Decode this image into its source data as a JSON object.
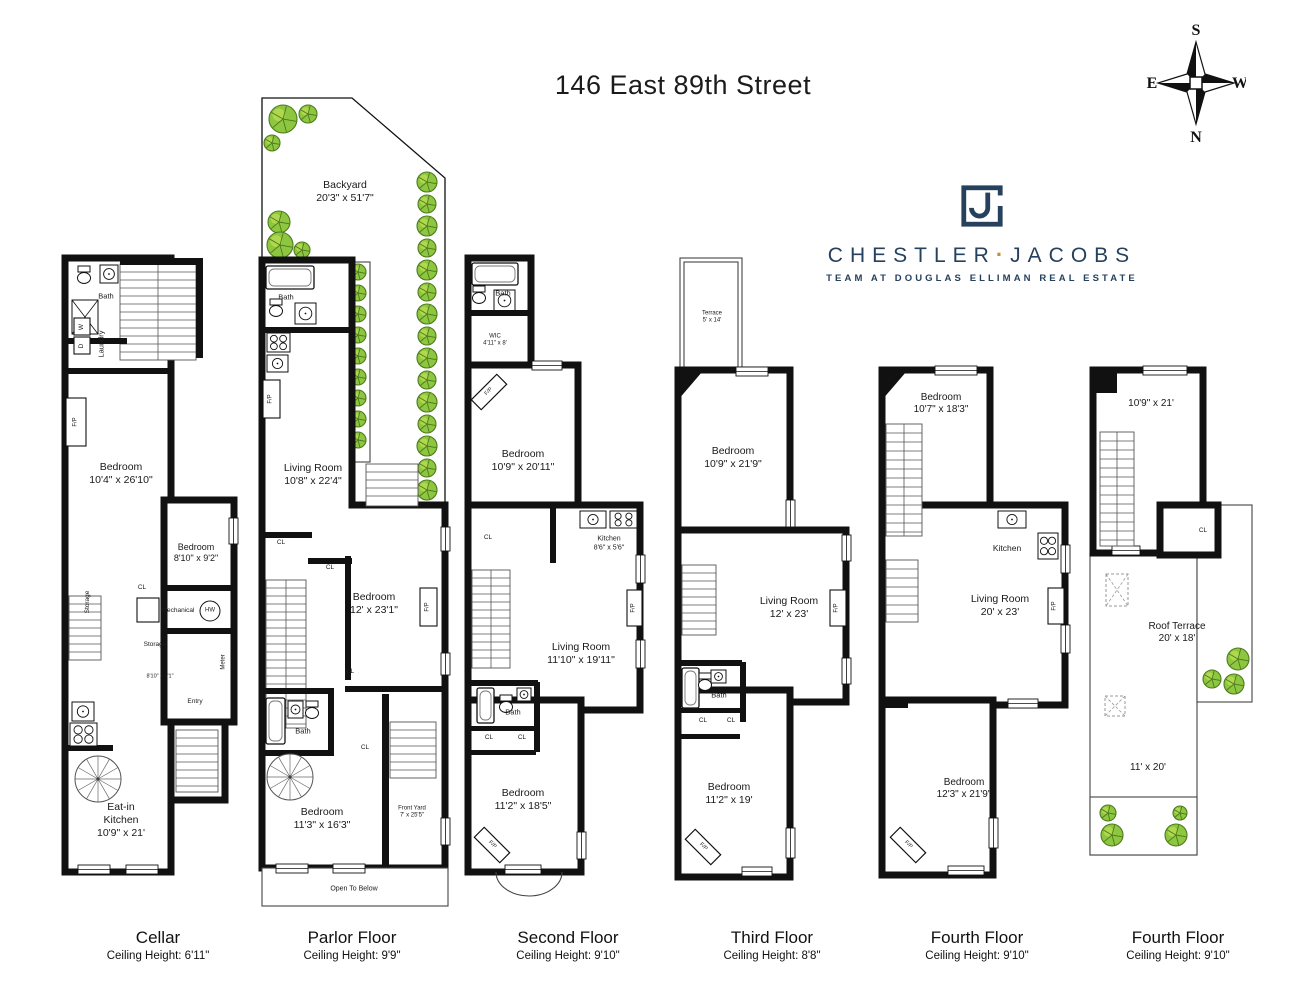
{
  "title": "146 East 89th Street",
  "compass": {
    "top": "S",
    "bottom": "N",
    "left": "E",
    "right": "W"
  },
  "logo": {
    "brand": "CHESTLER",
    "separator": "·",
    "brand2": "JACOBS",
    "tagline": "TEAM AT DOUGLAS ELLIMAN REAL ESTATE",
    "monogram": "CJ"
  },
  "colors": {
    "navy": "#26415e",
    "gold": "#c18f3c",
    "wall": "#111111",
    "tree_green": "#8dc63f",
    "tree_light": "#b9dc52",
    "tree_dark": "#4e7a1e"
  },
  "floors": [
    {
      "name": "Cellar",
      "ceiling": "Ceiling Height: 6'11\"",
      "labels": {
        "bath": "Bath",
        "w": "W",
        "d": "D",
        "laundry": "Laundry",
        "fp": "F/P",
        "bedroom1": [
          "Bedroom",
          "10'4\" x 26'10\""
        ],
        "storage1": "Storage",
        "cl": "CL",
        "bedroom2": [
          "Bedroom",
          "8'10\" x 9'2\""
        ],
        "mechanical": "Mechanical",
        "hw": "HW",
        "storage2": "Storage",
        "meter": "Meter",
        "hall": "8'10\" x 3'1\"",
        "entry": "Entry",
        "kitchen": [
          "Eat-in",
          "Kitchen",
          "10'9\" x 21'"
        ]
      }
    },
    {
      "name": "Parlor Floor",
      "ceiling": "Ceiling Height: 9'9\"",
      "labels": {
        "backyard": [
          "Backyard",
          "20'3\" x 51'7\""
        ],
        "bath1": "Bath",
        "fp1": "F/P",
        "living": [
          "Living Room",
          "10'8\" x 22'4\""
        ],
        "cl1": "CL",
        "cl2": "CL",
        "bedroom1": [
          "Bedroom",
          "12' x 23'1\""
        ],
        "fp2": "F/P",
        "cl3": "CL",
        "bath2": "Bath",
        "cl4": "CL",
        "bedroom2": [
          "Bedroom",
          "11'3\" x 16'3\""
        ],
        "frontyard": [
          "Front Yard",
          "7' x 25'5\""
        ],
        "open": "Open To Below"
      }
    },
    {
      "name": "Second Floor",
      "ceiling": "Ceiling Height: 9'10\"",
      "labels": {
        "bath1": "Bath",
        "wic": [
          "WIC",
          "4'11\" x 8'"
        ],
        "fp1": "F/P",
        "bedroom1": [
          "Bedroom",
          "10'9\" x 20'11\""
        ],
        "cl1": "CL",
        "kitchen": [
          "Kitchen",
          "8'6\" x 5'6\""
        ],
        "fp2": "F/P",
        "living": [
          "Living Room",
          "11'10\" x 19'11\""
        ],
        "bath2": "Bath",
        "cl2": "CL",
        "cl3": "CL",
        "bedroom2": [
          "Bedroom",
          "11'2\" x 18'5\""
        ],
        "fp3": "F/P"
      }
    },
    {
      "name": "Third Floor",
      "ceiling": "Ceiling Height: 8'8\"",
      "labels": {
        "terrace": [
          "Terrace",
          "5' x 14'"
        ],
        "bedroom1": [
          "Bedroom",
          "10'9\" x 21'9\""
        ],
        "living": [
          "Living Room",
          "12' x 23'"
        ],
        "fp1": "F/P",
        "bath": "Bath",
        "cl1": "CL",
        "cl2": "CL",
        "bedroom2": [
          "Bedroom",
          "11'2\" x 19'"
        ],
        "fp2": "F/P"
      }
    },
    {
      "name": "Fourth Floor",
      "ceiling": "Ceiling Height: 9'10\"",
      "labels": {
        "bedroom1": [
          "Bedroom",
          "10'7\" x 18'3\""
        ],
        "kitchen": "Kitchen",
        "living": [
          "Living Room",
          "20' x 23'"
        ],
        "fp1": "F/P",
        "bedroom2": [
          "Bedroom",
          "12'3\" x 21'9\""
        ],
        "fp2": "F/P"
      }
    },
    {
      "name": "Fourth Floor",
      "ceiling": "Ceiling Height: 9'10\"",
      "labels": {
        "room": "10'9\" x 21'",
        "cl": "CL",
        "terrace": [
          "Roof Terrace",
          "20' x 18'"
        ],
        "lower": "11' x 20'"
      }
    }
  ]
}
